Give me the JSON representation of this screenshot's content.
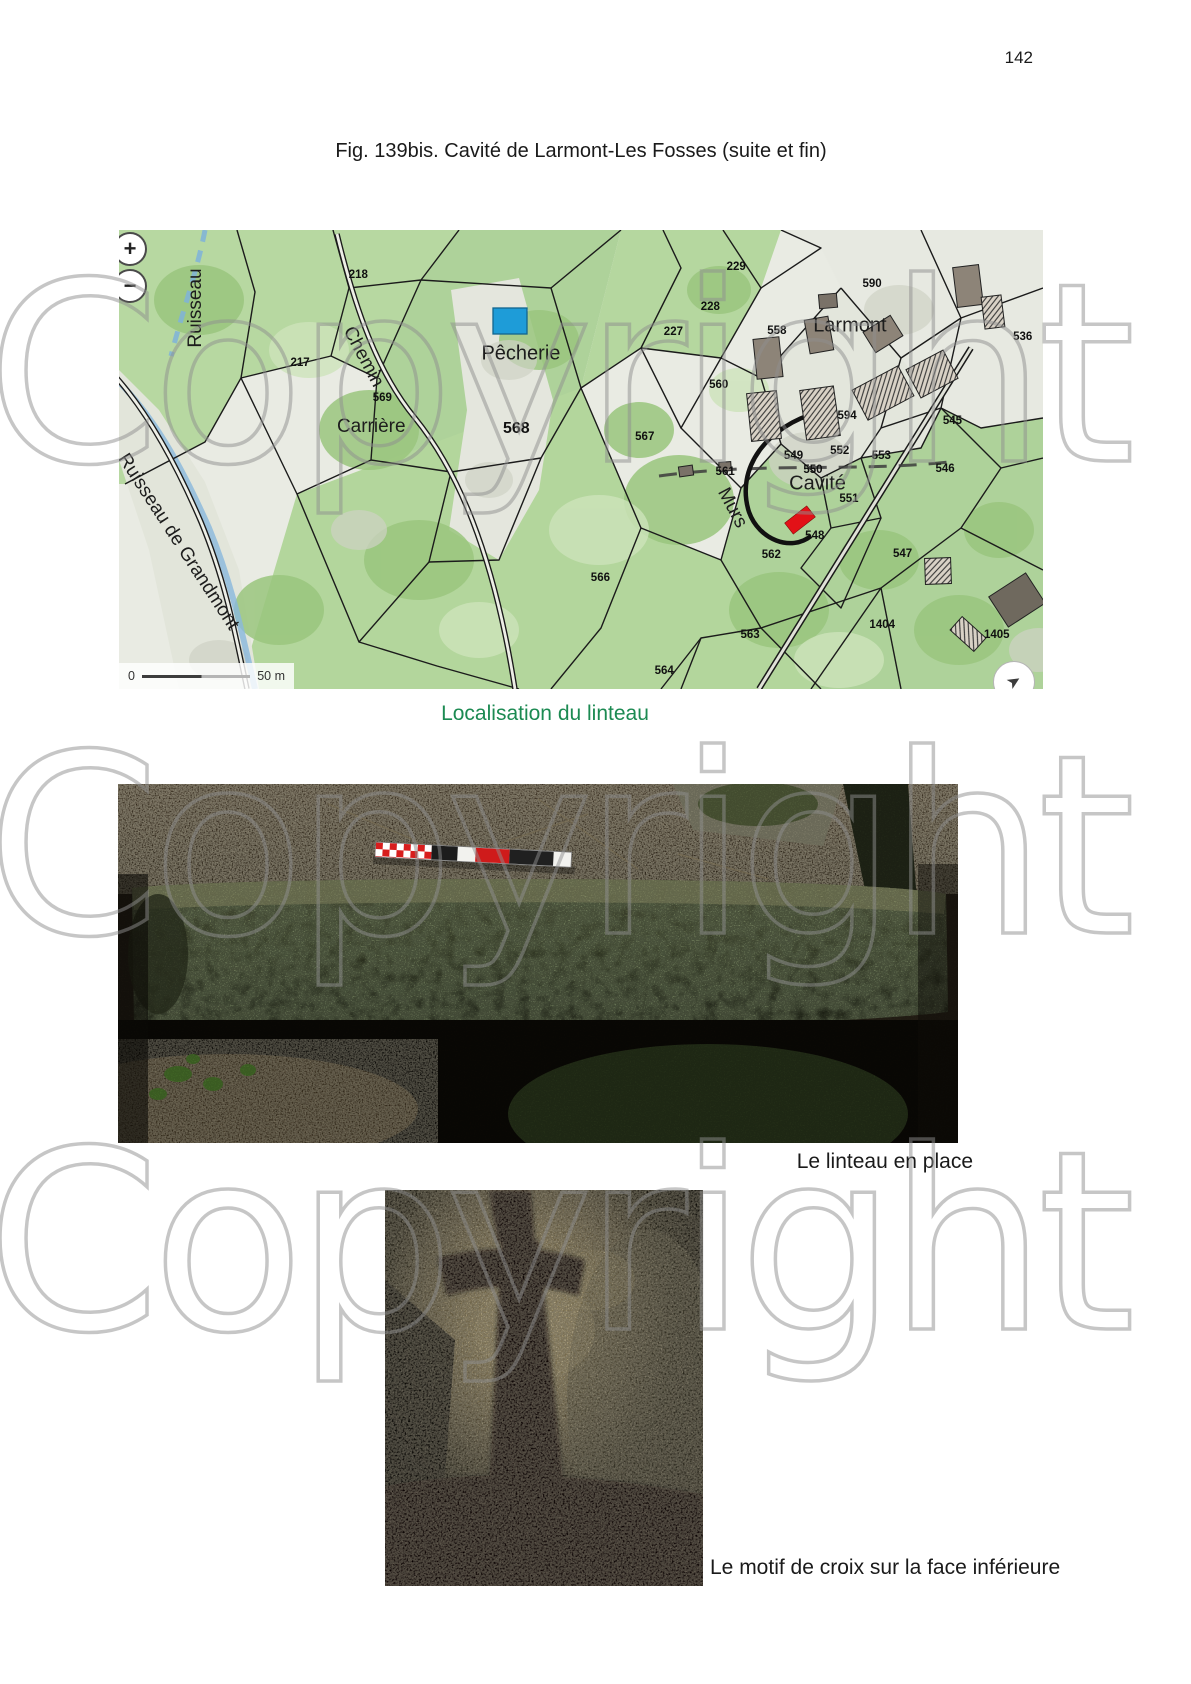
{
  "page": {
    "number": "142"
  },
  "figure": {
    "title": "Fig. 139bis. Cavité de Larmont-Les Fosses (suite et fin)"
  },
  "watermark": {
    "text": "Copyright",
    "color": "#8f8f8f",
    "tops": [
      250,
      722,
      1118
    ]
  },
  "map": {
    "caption": "Localisation du linteau",
    "caption_color": "#1c8a52",
    "zoom_in_label": "+",
    "zoom_out_label": "−",
    "scale": {
      "start": "0",
      "end": "50 m"
    },
    "compass_glyph": "➤",
    "colors": {
      "vegetation": "#b3d69c",
      "field": "#e7e9e1",
      "water": "#86b7dc",
      "cavity_marker": "#e31117",
      "pecherie_marker": "#1e9cd8"
    },
    "place_labels": [
      {
        "text": "Ruisseau",
        "x": 8.3,
        "y": 17.0,
        "rot": -90,
        "size": 19
      },
      {
        "text": "Ruisseau de Grandmont",
        "x": 6.4,
        "y": 68.0,
        "rot": 57,
        "size": 19
      },
      {
        "text": "Chemin",
        "x": 26.4,
        "y": 27.7,
        "rot": 62,
        "size": 19
      },
      {
        "text": "Carrière",
        "x": 27.3,
        "y": 42.9,
        "rot": 0,
        "size": 19
      },
      {
        "text": "Pêcherie",
        "x": 43.5,
        "y": 27.0,
        "rot": 0,
        "size": 20
      },
      {
        "text": "Larmont",
        "x": 79.1,
        "y": 20.9,
        "rot": 0,
        "size": 20
      },
      {
        "text": "Cavité",
        "x": 75.6,
        "y": 55.3,
        "rot": 0,
        "size": 20
      },
      {
        "text": "Murs",
        "x": 66.3,
        "y": 60.6,
        "rot": 62,
        "size": 19
      }
    ],
    "parcel_numbers": [
      {
        "text": "219",
        "x": 1.2,
        "y": 5.5
      },
      {
        "text": "218",
        "x": 25.9,
        "y": 9.8
      },
      {
        "text": "217",
        "x": 19.6,
        "y": 29.0
      },
      {
        "text": "229",
        "x": 66.8,
        "y": 8.1
      },
      {
        "text": "228",
        "x": 64.0,
        "y": 16.8
      },
      {
        "text": "227",
        "x": 60.0,
        "y": 22.2
      },
      {
        "text": "558",
        "x": 71.2,
        "y": 22.0
      },
      {
        "text": "590",
        "x": 81.5,
        "y": 11.8
      },
      {
        "text": "536",
        "x": 97.8,
        "y": 23.3
      },
      {
        "text": "560",
        "x": 64.9,
        "y": 33.8
      },
      {
        "text": "594",
        "x": 78.8,
        "y": 40.5
      },
      {
        "text": "545",
        "x": 90.2,
        "y": 41.6
      },
      {
        "text": "546",
        "x": 89.4,
        "y": 52.1
      },
      {
        "text": "553",
        "x": 82.5,
        "y": 49.2
      },
      {
        "text": "552",
        "x": 78.0,
        "y": 48.1
      },
      {
        "text": "549",
        "x": 73.0,
        "y": 49.2
      },
      {
        "text": "550",
        "x": 75.1,
        "y": 52.3
      },
      {
        "text": "551",
        "x": 79.0,
        "y": 58.6
      },
      {
        "text": "548",
        "x": 75.3,
        "y": 66.7
      },
      {
        "text": "547",
        "x": 84.8,
        "y": 70.6
      },
      {
        "text": "561",
        "x": 65.6,
        "y": 52.7
      },
      {
        "text": "562",
        "x": 70.6,
        "y": 70.8
      },
      {
        "text": "563",
        "x": 68.3,
        "y": 88.2
      },
      {
        "text": "564",
        "x": 59.0,
        "y": 96.0
      },
      {
        "text": "566",
        "x": 52.1,
        "y": 75.8
      },
      {
        "text": "567",
        "x": 56.9,
        "y": 45.1
      },
      {
        "text": "568",
        "x": 43.0,
        "y": 43.4,
        "size": 16
      },
      {
        "text": "569",
        "x": 28.5,
        "y": 36.6
      },
      {
        "text": "1404",
        "x": 82.6,
        "y": 86.1
      },
      {
        "text": "1405",
        "x": 95.0,
        "y": 88.2
      }
    ]
  },
  "photos": {
    "lintel": {
      "caption": "Le linteau en place"
    },
    "cross": {
      "caption": "Le motif de croix sur la face inférieure"
    }
  }
}
